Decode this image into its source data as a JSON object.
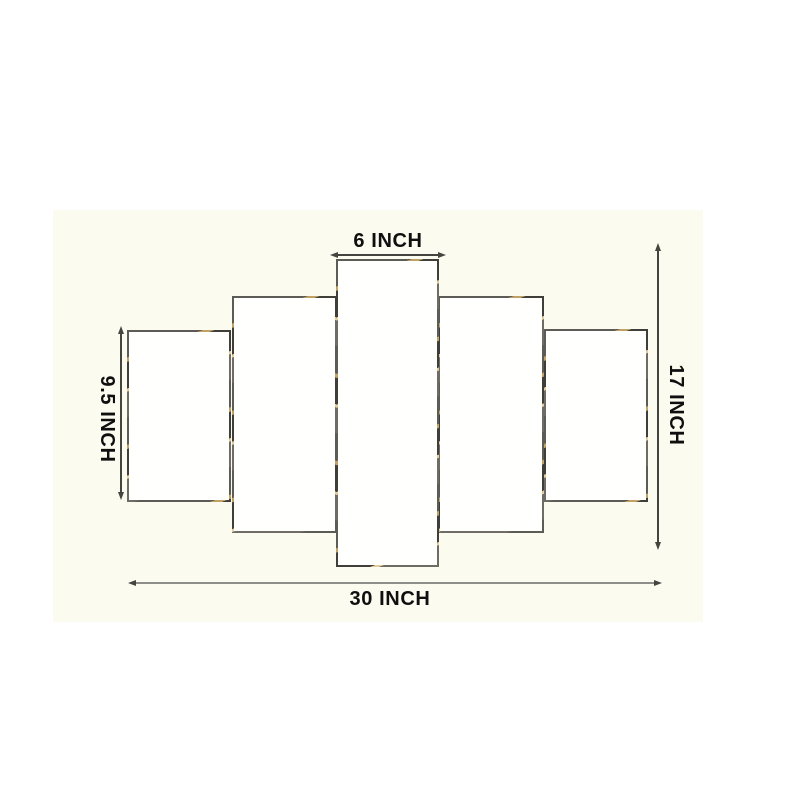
{
  "diagram": {
    "kind": "5-panel wall art dimension diagram",
    "panel_count": 5
  },
  "dimensions": {
    "top_width": "6 INCH",
    "left_height": "9.5 INCH",
    "right_height": "17 INCH",
    "bottom_width": "30 INCH"
  },
  "colors": {
    "page_background": "#ffffff",
    "photo_background": "#fbfbef",
    "panel_fill": "#fffffe",
    "panel_border": "#5d5b55",
    "gold_fleck": "#c2a264",
    "dimension_line": "#45443f",
    "bottom_line": "#8e8e88",
    "label_text": "#0f0f0f"
  }
}
